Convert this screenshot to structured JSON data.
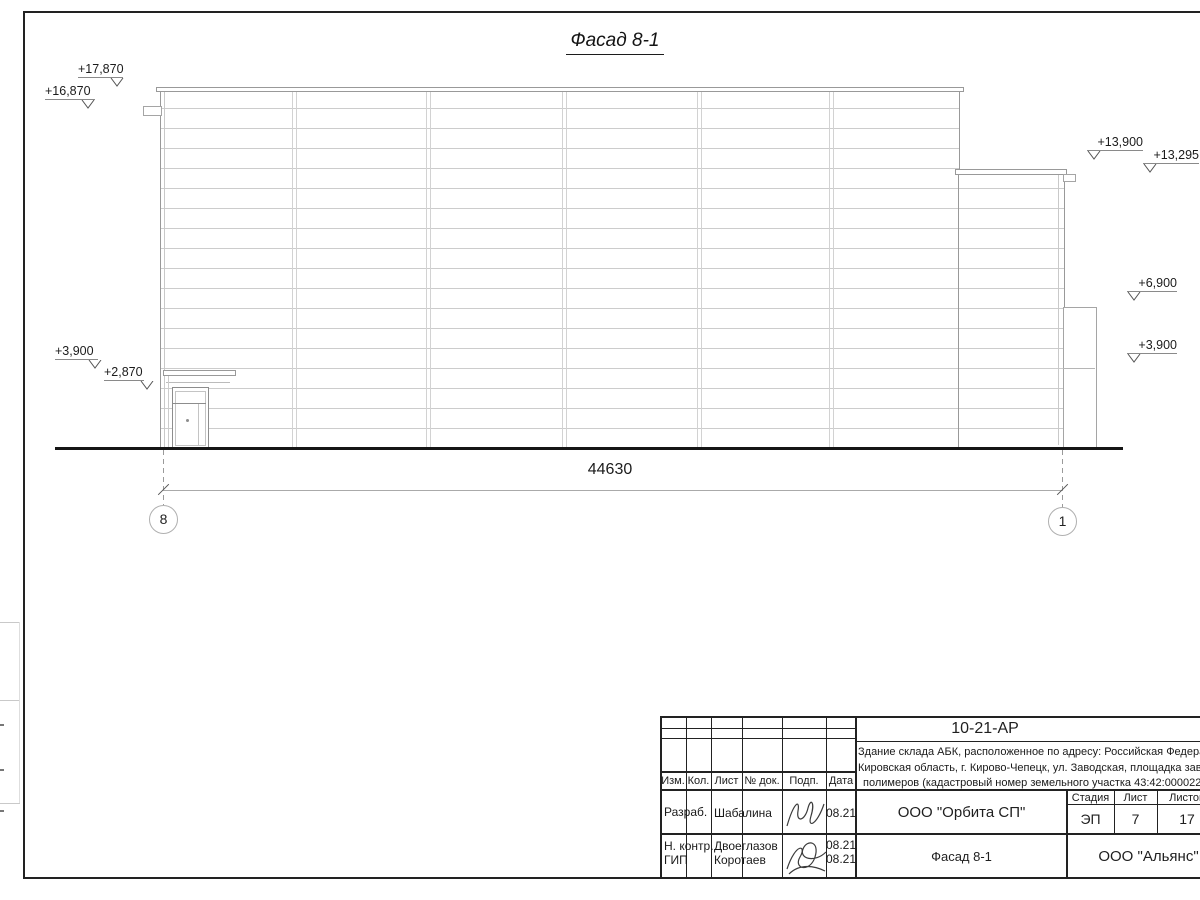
{
  "drawing": {
    "title": "Фасад 8-1",
    "dimension_total": "44630",
    "axis_left": "8",
    "axis_right": "1"
  },
  "levels": {
    "l1": "+17,870",
    "l2": "+16,870",
    "l3": "+3,900",
    "l4": "+2,870",
    "r1": "+13,900",
    "r2": "+13,295",
    "r3": "+6,900",
    "r4": "+3,900"
  },
  "title_block": {
    "doc_number": "10-21-АР",
    "description_line1": "Здание склада АБК, расположенное по адресу: Российская Федерац",
    "description_line2": "Кировская область, г. Кирово-Чепецк, ул. Заводская, площадка заво",
    "description_line3": "полимеров (кадастровый номер земельного участка 43:42:000022:",
    "col_izm": "Изм.",
    "col_kol": "Кол.",
    "col_list": "Лист",
    "col_doc": "№ док.",
    "col_podp": "Подп.",
    "col_data": "Дата",
    "row1_role": "Разраб.",
    "row1_name": "Шабалина",
    "row1_date": "08.21",
    "row2_role": "Н. контр.",
    "row2_name": "Двоеглазов",
    "row2_date": "08.21",
    "row3_role": "ГИП",
    "row3_name": "Коротаев",
    "row3_date": "08.21",
    "org": "ООО \"Орбита СП\"",
    "stage_label": "Стадия",
    "sheet_label": "Лист",
    "sheets_label": "Листов",
    "stage": "ЭП",
    "sheet_num": "7",
    "sheets_total": "17",
    "drawing_name": "Фасад 8-1",
    "contractor": "ООО \"Альянс\""
  },
  "colors": {
    "ink": "#1f1f1f",
    "outline": "#9a9a9a",
    "panel_line": "#cccccc",
    "ground": "#151515"
  }
}
